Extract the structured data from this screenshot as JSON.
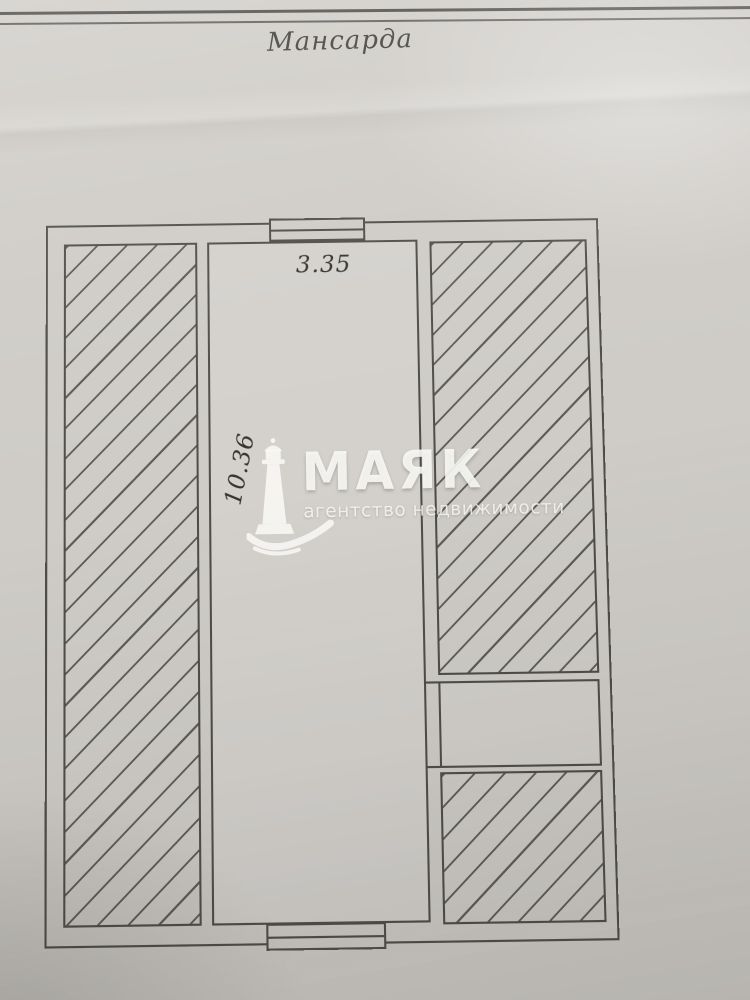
{
  "document": {
    "title": "Мансарда"
  },
  "plan": {
    "dimensions": {
      "width": "3.35",
      "length": "10.36"
    },
    "areas": {
      "left": "hatched",
      "center": "open room",
      "right_top": "hatched",
      "right_middle": "open band",
      "right_bottom": "hatched"
    }
  },
  "watermark": {
    "brand": "МАЯК",
    "subtitle": "агентство недвижимости",
    "icon": "lighthouse-icon"
  },
  "colors": {
    "paper": "#cfccc7",
    "ink": "#4f4d49",
    "watermark_white": "#f2f1ee"
  }
}
